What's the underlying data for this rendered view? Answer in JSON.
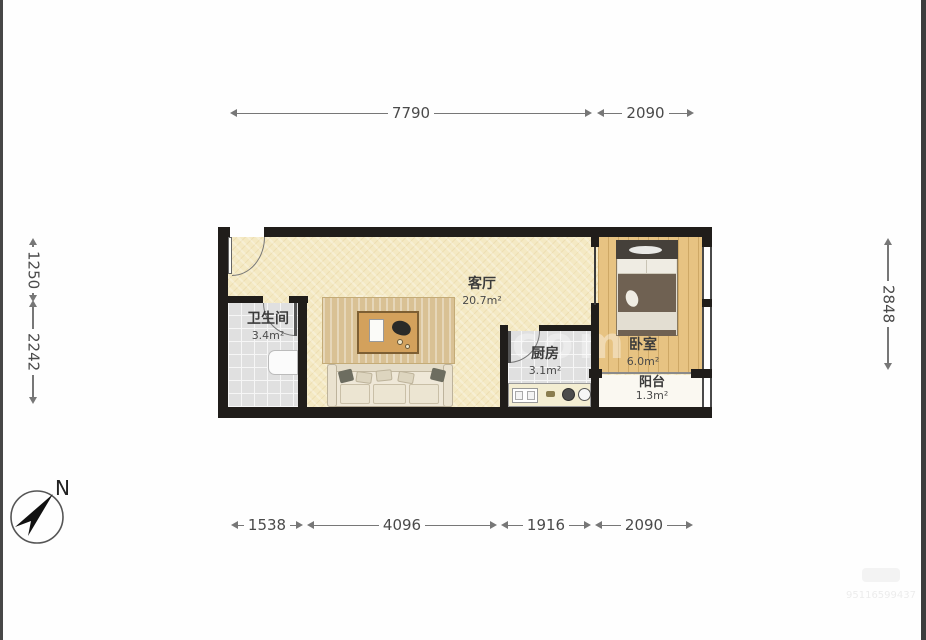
{
  "plan_type": "apartment-floor-plan",
  "compass": {
    "label": "N"
  },
  "rooms": {
    "living": {
      "name": "客厅",
      "area": "20.7m²"
    },
    "bath": {
      "name": "卫生间",
      "area": "3.4m²"
    },
    "kitchen": {
      "name": "厨房",
      "area": "3.1m²"
    },
    "bedroom": {
      "name": "卧室",
      "area": "6.0m²"
    },
    "balcony": {
      "name": "阳台",
      "area": "1.3m²"
    }
  },
  "dimensions": {
    "top": [
      "7790",
      "2090"
    ],
    "bottom": [
      "1538",
      "4096",
      "1916",
      "2090"
    ],
    "left": [
      "1250",
      "2242"
    ],
    "right": [
      "2848"
    ]
  },
  "watermark": {
    "center_left": "lian",
    "center_right": "com",
    "corner_code": "95116599437"
  },
  "colors": {
    "wall": "#201d1a",
    "floor_living": "#f4e9c3",
    "floor_tile": "#e0e0e0",
    "floor_wood": "#e7c382",
    "floor_balcony": "#faf8f1",
    "dimension_text": "#4a4a4a"
  }
}
